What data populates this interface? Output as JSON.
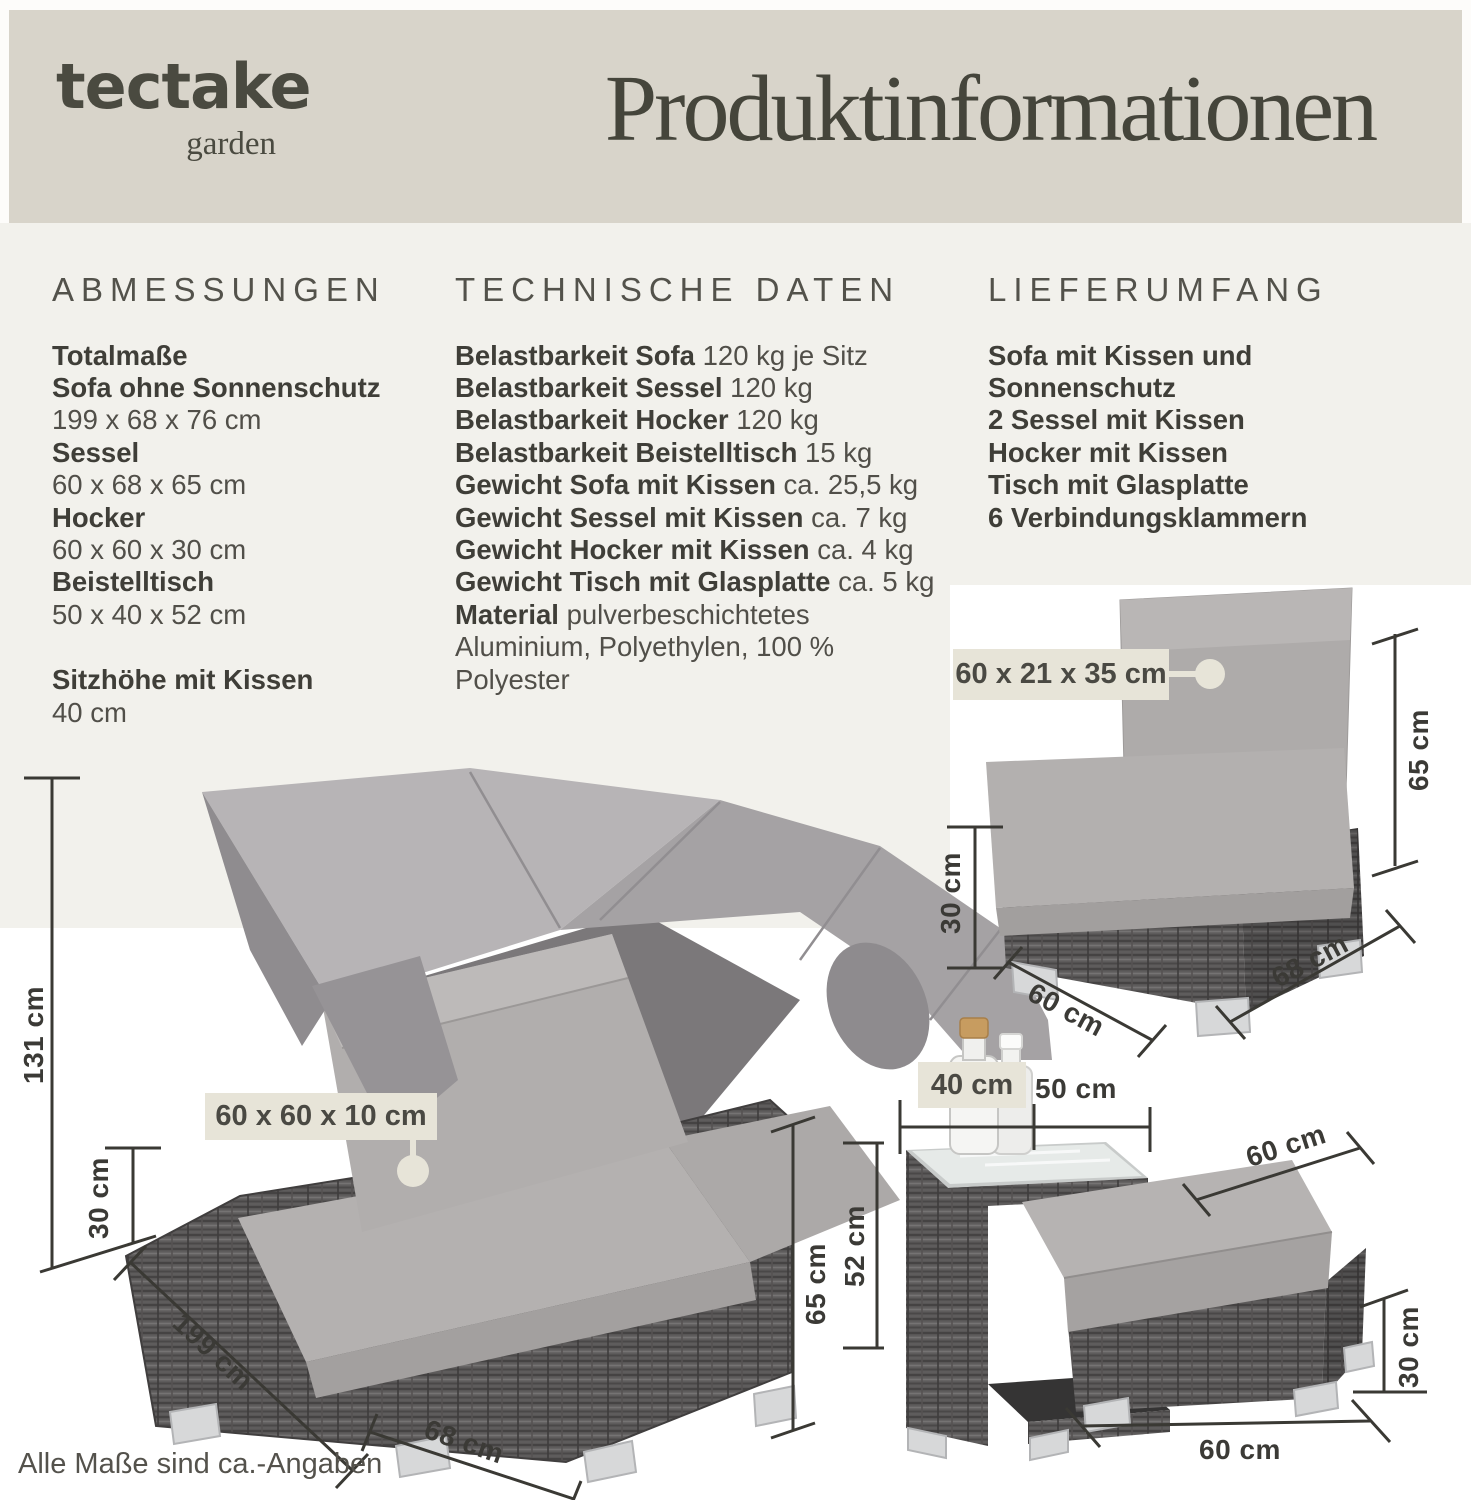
{
  "header": {
    "logo_main": "tectake",
    "logo_sub": "garden",
    "title": "Produktinformationen"
  },
  "sections": {
    "abmessungen": {
      "heading": "ABMESSUNGEN",
      "lines": [
        {
          "b": "Totalmaße"
        },
        {
          "b": "Sofa ohne Sonnenschutz"
        },
        {
          "t": "199 x 68 x 76 cm"
        },
        {
          "b": "Sessel"
        },
        {
          "t": "60 x 68 x 65 cm"
        },
        {
          "b": "Hocker"
        },
        {
          "t": "60 x 60 x 30 cm"
        },
        {
          "b": "Beistelltisch"
        },
        {
          "t": "50 x 40 x 52 cm"
        },
        {
          "b": "Sitzhöhe mit Kissen"
        },
        {
          "t": "40 cm"
        }
      ]
    },
    "technische_daten": {
      "heading": "TECHNISCHE DATEN",
      "lines": [
        {
          "b": "Belastbarkeit Sofa",
          "t": " 120 kg je Sitz"
        },
        {
          "b": "Belastbarkeit Sessel",
          "t": " 120 kg"
        },
        {
          "b": "Belastbarkeit Hocker",
          "t": " 120 kg"
        },
        {
          "b": "Belastbarkeit Beistelltisch",
          "t": " 15 kg"
        },
        {
          "b": "Gewicht Sofa mit Kissen",
          "t": " ca. 25,5 kg"
        },
        {
          "b": "Gewicht Sessel mit Kissen",
          "t": " ca. 7 kg"
        },
        {
          "b": "Gewicht Hocker mit Kissen",
          "t": " ca. 4 kg"
        },
        {
          "b": "Gewicht Tisch mit Glasplatte",
          "t": " ca. 5 kg"
        },
        {
          "b": "Material",
          "t": " pulverbeschichtetes"
        },
        {
          "t": "Aluminium, Polyethylen, 100 %"
        },
        {
          "t": "Polyester"
        }
      ]
    },
    "lieferumfang": {
      "heading": "LIEFERUMFANG",
      "lines": [
        {
          "b": "Sofa mit Kissen und"
        },
        {
          "b": "Sonnenschutz"
        },
        {
          "b": "2 Sessel mit Kissen"
        },
        {
          "b": "Hocker mit Kissen"
        },
        {
          "b": "Tisch mit Glasplatte"
        },
        {
          "b": "6 Verbindungsklammern"
        }
      ]
    }
  },
  "tags": {
    "sofa_cushion": "60 x 60 x 10 cm",
    "chair_cushion": "60 x 21 x 35 cm",
    "table_width": "40 cm"
  },
  "dims": {
    "sofa_total_height": "131 cm",
    "sofa_base_height": "30 cm",
    "sofa_length": "199 cm",
    "sofa_depth": "68 cm",
    "sofa_height": "65 cm",
    "chair_height": "65 cm",
    "chair_base_height": "30 cm",
    "chair_width": "60 cm",
    "chair_depth": "68 cm",
    "table_depth": "50 cm",
    "table_height": "52 cm",
    "ottoman_width": "60 cm",
    "ottoman_height": "30 cm",
    "ottoman_width_bottom": "60 cm"
  },
  "footnote": "Alle Maße sind ca.-Angaben",
  "colors": {
    "band": "#d8d4ca",
    "page_bg": "#f2f1ec",
    "photo_bg": "#ffffff",
    "tag_bg": "#e7e4d8",
    "text_dark": "#3f3e38",
    "dim_line": "#3a3934"
  }
}
